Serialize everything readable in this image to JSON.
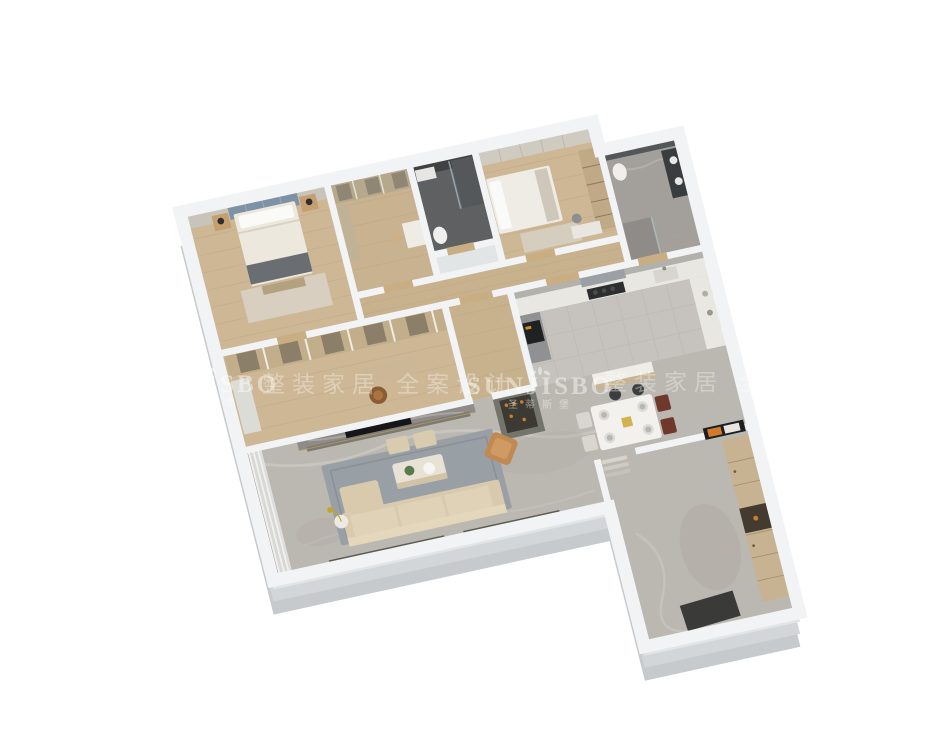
{
  "watermark": {
    "brand_latin": "SUNJISBO",
    "brand_cn": "圣蒂斯堡",
    "tagline_cn": "整装家居 全案设计",
    "icon": "laurel-crown-icon",
    "color": "#ffffff"
  },
  "palette": {
    "background": "#ffffff",
    "wall_top": "#f2f3f4",
    "wall_face_dark": "#c6cacc",
    "wall_face_mid": "#d2d6d8",
    "wall_face_light": "#e2e5e6",
    "wood_floor": "#cdb795",
    "marble_floor": "#bbb7b1",
    "kitchen_tile": "#c6c3be",
    "dark_bath_tile": "#5e6062",
    "master_bath_marble": "#a3a09c",
    "headboard_blue": "#7e92a6",
    "tv_wall_marble": "#8e8b88",
    "tv_screen": "#141619",
    "sofa_beige": "#d9c9ad",
    "armchair_caramel": "#c08a52",
    "rug_blue_grey": "#99a0a5",
    "dining_chair_red": "#6e392c",
    "wardrobe_tan": "#c7b391",
    "wine_cabinet_olive": "#73746a",
    "gold_accent": "#b8995a"
  }
}
